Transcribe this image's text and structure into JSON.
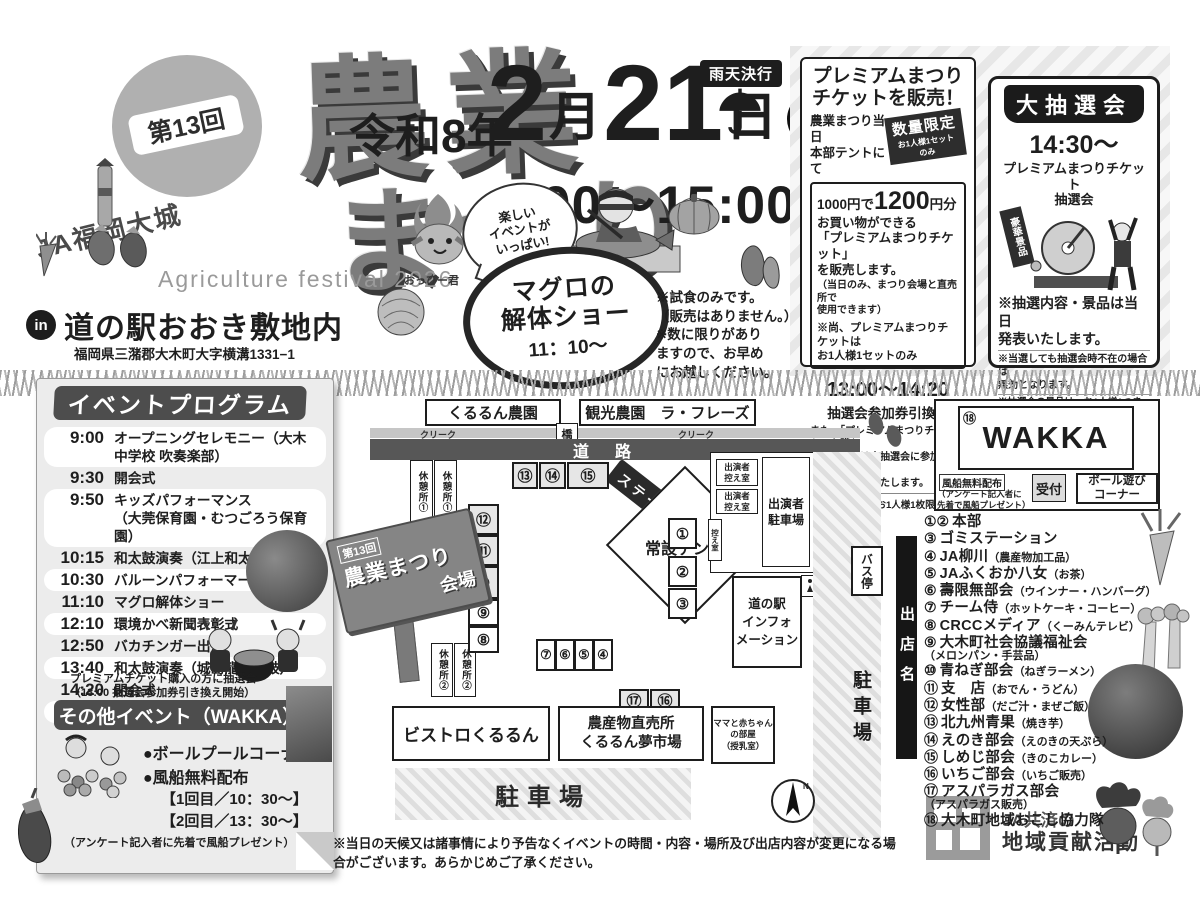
{
  "colors": {
    "ink": "#1e1e1e",
    "dark_gray": "#4d4d4d",
    "mid_gray": "#8a8a8a",
    "light_fill": "#e6e6e6",
    "paper": "#ececec"
  },
  "header": {
    "edition": "第13回",
    "org": "JA福岡大城",
    "title_1": "農業",
    "title_2": "まつり",
    "subtitle": "Agriculture festival 2026",
    "era": "令和8年",
    "month_num": "2",
    "month_unit": "月",
    "day_num": "21",
    "day_unit": "日",
    "weekday": "土",
    "rain": "雨天決行",
    "time": "9:00〜15:00",
    "in_mark": "in",
    "venue": "道の駅おおき敷地内",
    "address": "福岡県三潴郡大木町大字横溝1331−1",
    "bubble": "楽しい\nイベントが\nいっぱい!",
    "mascot": "おっぴー君",
    "tuna_title": "マグロの\n解体ショー",
    "tuna_time": "11：10〜",
    "tuna_note": "※試食のみです。\n（販売はありません。）\n※数に限りがあり\nますので、お早め\nにお越しください。"
  },
  "premium": {
    "title": "プレミアムまつり\nチケットを販売！",
    "when": "農業まつり当日\n本部テントにて",
    "limited": "数量限定",
    "limited_sub": "お1人様1セットのみ",
    "price_a": "1000円で",
    "price_b": "1200",
    "price_c": "円分",
    "body": "お買い物ができる\n「プレミアムまつりチケット」\nを販売します。",
    "body_note": "（当日のみ、まつり会場と直売所で\n使用できます）",
    "note1": "※尚、プレミアムまつりチケットは\nお1人様1セットのみ",
    "exchange_time": "13:00〜14:20",
    "exchange": "抽選会参加券引換え",
    "note2": "また、「プレミアムまつりチケット」を購入\nされた方には大抽選会に参加できる\n抽選券を配布いたします。",
    "note3": "※尚、抽選券はお1人様1枚限りとなります。"
  },
  "lottery": {
    "banner": "大抽選会",
    "time": "14:30〜",
    "subtitle": "プレミアムまつりチケット\n抽選会",
    "prize_sign": "豪華景品",
    "note1": "※抽選内容・景品は当日\n発表いたします。",
    "note2": "※当選しても抽選会時不在の場合は\n無効となります。",
    "note3": "※抽選会の景品は、お1人様1つまで\nとなり代理人による抽選は無効となり\nます。ご理解とご協力をお願いいたします。"
  },
  "program": {
    "title": "イベントプログラム",
    "items": [
      {
        "time": "9:00",
        "event": "オープニングセレモニー（大木中学校 吹奏楽部）"
      },
      {
        "time": "9:30",
        "event": "開会式"
      },
      {
        "time": "9:50",
        "event": "キッズパフォーマンス\n（大莞保育園・むつごろう保育園）"
      },
      {
        "time": "10:15",
        "event": "和太鼓演奏（江上和太鼓　郷蓮）"
      },
      {
        "time": "10:30",
        "event": "バルーンパフォーマーRYU"
      },
      {
        "time": "11:10",
        "event": "マグロ解体ショー"
      },
      {
        "time": "12:10",
        "event": "環境かべ新聞表彰式"
      },
      {
        "time": "12:50",
        "event": "バカチンガー出演"
      },
      {
        "time": "13:40",
        "event": "和太鼓演奏（城島龍神太鼓）"
      },
      {
        "time": "14:20",
        "event": "閉会式"
      },
      {
        "time": "14:30",
        "event": "大抽選会"
      }
    ],
    "note": "プレミアムチケット購入の方に抽選会\n（13:00 抽選会参加券引き換え開始）"
  },
  "other": {
    "title": "その他イベント（WAKKA）",
    "item1": "●ボールプールコーナー",
    "item2": "●風船無料配布",
    "time1": "【1回目／10：30〜】",
    "time2": "【2回目／13：30〜】",
    "note": "（アンケート記入者に先着で風船プレゼント）"
  },
  "map": {
    "farm1": "くるるん農園",
    "farm2": "観光農園　ラ・フレーズ",
    "creek": "クリーク",
    "bridge": "橋",
    "road": "道路",
    "sound": "音",
    "stage": "ステージ",
    "tent": "常設テント",
    "rest1": "休憩所①",
    "rest2": "休憩所②",
    "sign_line1": "第13回",
    "sign_line2": "農業まつり",
    "sign_line3": "会場",
    "stalls_top": [
      "⑬",
      "⑭",
      "⑮"
    ],
    "stalls_left": [
      "⑫",
      "⑪",
      "⑩",
      "⑨",
      "⑧"
    ],
    "stalls_right": [
      "①",
      "②",
      "③"
    ],
    "stalls_mid": [
      "⑦",
      "⑥",
      "⑤",
      "④"
    ],
    "stalls_bottom": [
      "⑰",
      "⑯"
    ],
    "performer_room": "出演者\n控え室",
    "performer_parking": "出演者\n駐車場",
    "waiting": "控え室",
    "bus_stop": "バス停",
    "info": "道の駅\nインフォ\nメーション",
    "bistro": "ビストロくるるん",
    "market": "農産物直売所\nくるるん夢市場",
    "mama": "ママと赤ちゃん\nの部屋\n（授乳室）",
    "parking_main": "駐車場",
    "parking_side": "駐車場",
    "store_label": "出店名",
    "north": "N"
  },
  "wakka": {
    "number": "⑱",
    "name": "WAKKA",
    "balloon": "風船無料配布",
    "balloon_note": "（アンケート記入者に\n先着で風船プレゼント）",
    "reception": "受付",
    "ball_corner": "ボール遊び\nコーナー"
  },
  "stores": {
    "items": [
      {
        "no": "①②",
        "name": "本部",
        "detail": ""
      },
      {
        "no": "③",
        "name": "ゴミステーション",
        "detail": ""
      },
      {
        "no": "④",
        "name": "JA柳川",
        "detail": "（農産物加工品）"
      },
      {
        "no": "⑤",
        "name": "JAふくおか八女",
        "detail": "（お茶）"
      },
      {
        "no": "⑥",
        "name": "壽限無部会",
        "detail": "（ウインナー・ハンバーグ）"
      },
      {
        "no": "⑦",
        "name": "チーム侍",
        "detail": "（ホットケーキ・コーヒー）"
      },
      {
        "no": "⑧",
        "name": "CRCCメディア",
        "detail": "（くーみんテレビ）"
      },
      {
        "no": "⑨",
        "name": "大木町社会協議福祉会",
        "detail": "（メロンパン・手芸品）"
      },
      {
        "no": "⑩",
        "name": "青ねぎ部会",
        "detail": "（ねぎラーメン）"
      },
      {
        "no": "⑪",
        "name": "支　店",
        "detail": "（おでん・うどん）"
      },
      {
        "no": "⑫",
        "name": "女性部",
        "detail": "（だご汁・まぜご飯）"
      },
      {
        "no": "⑬",
        "name": "北九州青果",
        "detail": "（焼き芋）"
      },
      {
        "no": "⑭",
        "name": "えのき部会",
        "detail": "（えのきの天ぷら）"
      },
      {
        "no": "⑮",
        "name": "しめじ部会",
        "detail": "（きのこカレー）"
      },
      {
        "no": "⑯",
        "name": "いちご部会",
        "detail": "（いちご販売）"
      },
      {
        "no": "⑰",
        "name": "アスパラガス部会",
        "detail": "（アスパラガス販売）"
      },
      {
        "no": "⑱",
        "name": "大木町地域おこし協力隊",
        "detail": ""
      }
    ]
  },
  "footer": {
    "disclaimer": "※当日の天候又は諸事情により予告なくイベントの時間・内容・場所及び出店内容が変更になる場合がございます。あらかじめご了承ください。",
    "ja_line1": "JA共済の",
    "ja_line2": "地域貢献活動"
  }
}
